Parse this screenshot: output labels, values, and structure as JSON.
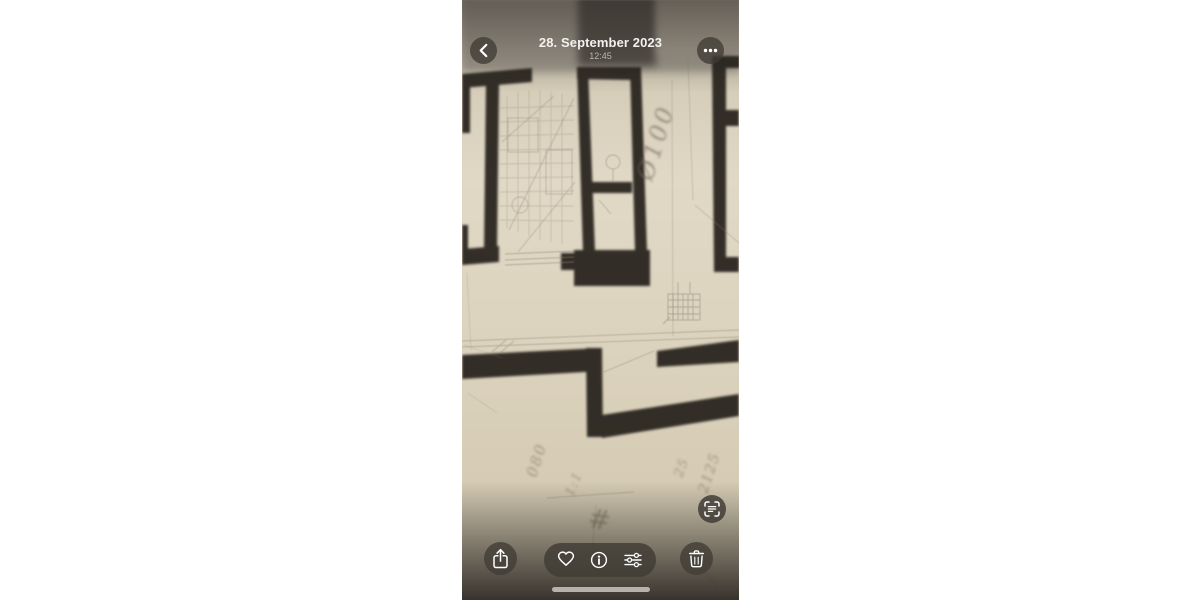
{
  "header": {
    "date": "28. September 2023",
    "time": "12:45",
    "back_icon": "chevron-left",
    "more_icon": "ellipsis-horizontal"
  },
  "photo": {
    "kind": "architectural floor plan photograph",
    "handwriting": {
      "phi": "Ø100",
      "left": "080",
      "ratio": "1:1",
      "hash": "#",
      "small_right": "25",
      "right": "2125"
    }
  },
  "toolbar": {
    "share_icon": "share-up-arrow",
    "favorite_icon": "heart-outline",
    "info_icon": "info-circle",
    "adjust_icon": "sliders",
    "delete_icon": "trash",
    "live_text_icon": "live-text-viewfinder"
  },
  "colors": {
    "paper": "#ddd4c0",
    "wall_ink": "#26231e",
    "pencil": "#847c6b",
    "button_bg": "rgba(64,60,53,0.78)",
    "icon": "#ffffff",
    "home_indicator": "#b6b2ab"
  }
}
